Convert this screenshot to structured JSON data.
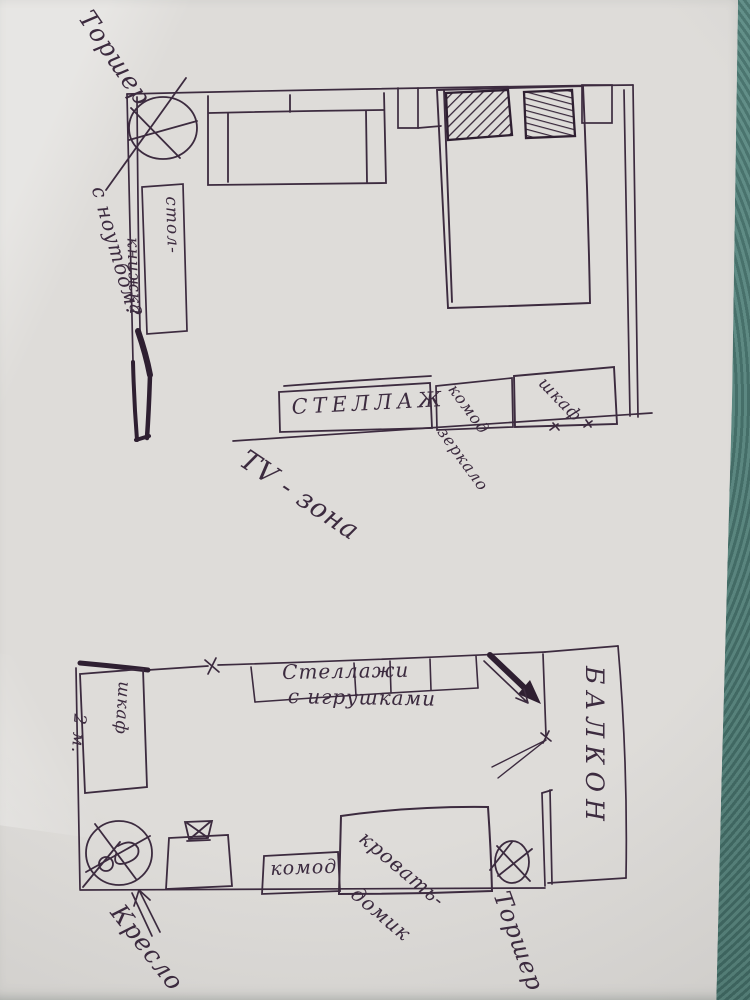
{
  "photo": {
    "ink_color": "#3c2b3f",
    "paper_color": "#d8d6d3",
    "background_color": "#5f8d87"
  },
  "plan_top": {
    "lamp_label": "Торшер",
    "table_book_line1": "стол-",
    "table_book_line2": "книжка",
    "laptop_note": "с ноутбом?",
    "shelving_label": "СТЕЛЛАЖ",
    "dresser_line1": "комод",
    "dresser_line2": "зеркало",
    "wardrobe_label": "шкаф",
    "tv_zone_label": "TV - зона"
  },
  "plan_bottom": {
    "wardrobe_line1": "шкаф",
    "wardrobe_line2": "2 м.",
    "shelves_line1": "Стеллажи",
    "shelves_line2": "с игрушками",
    "balcony_label": "БАЛКОН",
    "bed_line1": "кровать-",
    "bed_line2": "домик",
    "dresser_label": "комод",
    "armchair_label": "Кресло",
    "lamp_label": "Торшер"
  }
}
